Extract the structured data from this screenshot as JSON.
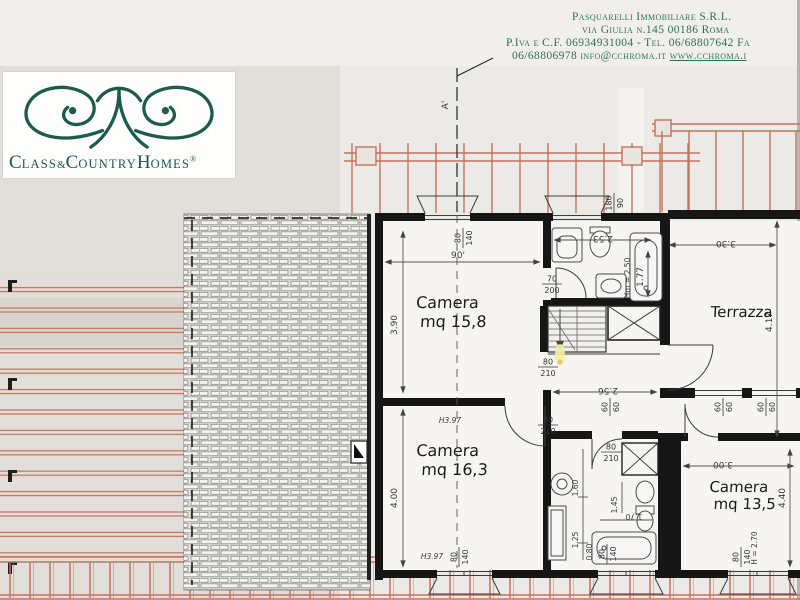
{
  "header": {
    "line1": "Pasquarelli Immobiliare S.R.L.",
    "line2": "via Giulia n.145  00186 Roma",
    "line3": "P.Iva e C.F. 06934931004 - Tel. 06/68807642 Fa",
    "line4_text": "06/68806978 info@cchroma.it ",
    "line4_link": "www.cchroma.i"
  },
  "logo": {
    "c1": "C",
    "s1": "LASS",
    "amp": "&",
    "c2": "C",
    "s2": "OUNTRY",
    "h": "H",
    "s3": "OMES",
    "reg": "®"
  },
  "plan": {
    "section_label": "A'",
    "rooms": {
      "camera1_name": "Camera",
      "camera1_area": "mq 15,8",
      "camera2_name": "Camera",
      "camera2_area": "mq 16,3",
      "camera3_name": "Camera",
      "camera3_area": "mq 13,5",
      "terrazza": "Terrazza"
    },
    "dims": {
      "d390": "3.90",
      "d90": "90'",
      "d253": "2.53",
      "dhm250": "Hm = 2.50",
      "d177": "1.77",
      "d330": "3.30",
      "d417": "4.17",
      "d256": "2.56",
      "d400": "4.00",
      "h397a": "H3.97",
      "h397b": "H3.97",
      "d160": "1.60",
      "d125": "1.25",
      "d080": "0.80",
      "d145": "1.45",
      "d170": "1.70",
      "d300": "3.00",
      "d440": "4.40",
      "dh270": "H = 2.70"
    },
    "fracs": {
      "win_top": {
        "n": "80",
        "d": "140"
      },
      "win_18090": {
        "n": "180",
        "d": "90"
      },
      "door_bath1": {
        "n": "70",
        "d": "200"
      },
      "door_cam158": {
        "n": "80",
        "d": "210"
      },
      "door_cam163": {
        "n": "80",
        "d": "210"
      },
      "door_bath2": {
        "n": "80",
        "d": "210"
      },
      "win_cam163": {
        "n": "80",
        "d": "140"
      },
      "win_bath2": {
        "n": "80",
        "d": "140"
      },
      "win_cam135": {
        "n": "80",
        "d": "140"
      },
      "win_60a": {
        "n": "60",
        "d": "60"
      },
      "win_60b": {
        "n": "60",
        "d": "60"
      },
      "win_60c": {
        "n": "60",
        "d": "60"
      }
    }
  },
  "colors": {
    "brand_green": "#1d5c49",
    "header_green": "#2d6e5a",
    "railing_orange": "#c4725a"
  }
}
